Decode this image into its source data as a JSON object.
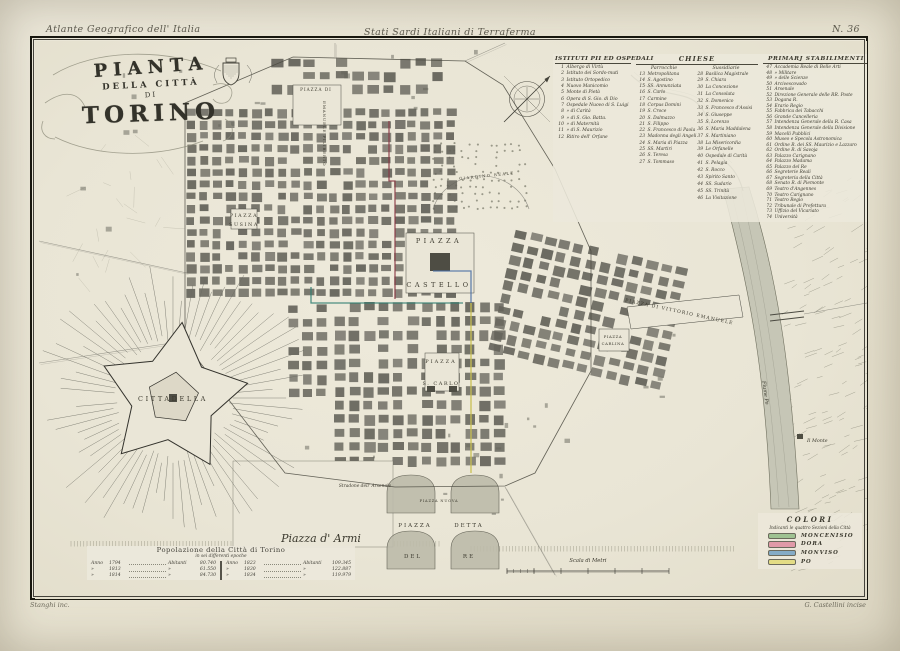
{
  "page": {
    "top_left_annotation": "Atlante Geografico dell' Italia",
    "top_center_annotation": "Stati Sardi Italiani di Terraferma",
    "plate_number": "N. 36",
    "bottom_left_signature": "Stanghi inc.",
    "bottom_right_signature": "G. Castellini incise"
  },
  "title": {
    "line1": "PIANTA",
    "line2": "DELLA CITTÀ",
    "line3": "DI",
    "line4": "TORINO"
  },
  "legend": {
    "col1_header": "ISTITUTI PII ED OSPEDALI",
    "chiese_header": "CHIESE",
    "parrocchie_subheader": "Parrocchie",
    "sussidiarie_subheader": "Sussidiarie",
    "primarj_header": "PRIMARJ STABILIMENTI",
    "istituti": [
      {
        "n": "1",
        "name": "Albergo di Virtù"
      },
      {
        "n": "2",
        "name": "Istituto dei Sordo-muti"
      },
      {
        "n": "3",
        "name": "Istituto Ortopedico"
      },
      {
        "n": "4",
        "name": "Nuovo Manicomio"
      },
      {
        "n": "5",
        "name": "Monte di Pietà"
      },
      {
        "n": "6",
        "name": "Opera di S. Gio. di Dio"
      },
      {
        "n": "7",
        "name": "Ospedale Nuovo di S. Luigi"
      },
      {
        "n": "8",
        "name": "»  di Carità"
      },
      {
        "n": "9",
        "name": "»  di S. Gio. Batta."
      },
      {
        "n": "10",
        "name": "»  di Maternità"
      },
      {
        "n": "11",
        "name": "»  di S. Maurizio"
      },
      {
        "n": "12",
        "name": "Ritiro dell' Orfane"
      }
    ],
    "parrocchie": [
      {
        "n": "13",
        "name": "Metropolitana"
      },
      {
        "n": "14",
        "name": "S. Agostino"
      },
      {
        "n": "15",
        "name": "SS. Annunziata"
      },
      {
        "n": "16",
        "name": "S. Carlo"
      },
      {
        "n": "17",
        "name": "Carmine"
      },
      {
        "n": "18",
        "name": "Corpus Domini"
      },
      {
        "n": "19",
        "name": "S. Croce"
      },
      {
        "n": "20",
        "name": "S. Dalmazzo"
      },
      {
        "n": "21",
        "name": "S. Filippo"
      },
      {
        "n": "22",
        "name": "S. Francesco di Paola"
      },
      {
        "n": "23",
        "name": "Madonna degli Angeli"
      },
      {
        "n": "24",
        "name": "S. Maria di Piazza"
      },
      {
        "n": "25",
        "name": "SS. Martiri"
      },
      {
        "n": "26",
        "name": "S. Teresa"
      },
      {
        "n": "27",
        "name": "S. Tommaso"
      }
    ],
    "sussidiarie": [
      {
        "n": "28",
        "name": "Basilica Magistrale"
      },
      {
        "n": "29",
        "name": "S. Chiara"
      },
      {
        "n": "30",
        "name": "La Concezione"
      },
      {
        "n": "31",
        "name": "La Consolata"
      },
      {
        "n": "32",
        "name": "S. Domenico"
      },
      {
        "n": "33",
        "name": "S. Francesco d'Assisi"
      },
      {
        "n": "34",
        "name": "S. Giuseppe"
      },
      {
        "n": "35",
        "name": "S. Lorenzo"
      },
      {
        "n": "36",
        "name": "S. Maria Maddalena"
      },
      {
        "n": "37",
        "name": "S. Martiniano"
      },
      {
        "n": "38",
        "name": "La Misericordia"
      },
      {
        "n": "39",
        "name": "Le Orfanelle"
      },
      {
        "n": "40",
        "name": "Ospedale di Carità"
      },
      {
        "n": "41",
        "name": "S. Pelagia"
      },
      {
        "n": "42",
        "name": "S. Rocco"
      },
      {
        "n": "43",
        "name": "Spirito Santo"
      },
      {
        "n": "44",
        "name": "SS. Sudario"
      },
      {
        "n": "45",
        "name": "SS. Trinità"
      },
      {
        "n": "46",
        "name": "La Visitazione"
      }
    ],
    "primarj": [
      {
        "n": "47",
        "name": "Accademia Reale di Belle Arti"
      },
      {
        "n": "48",
        "name": "»  Militare"
      },
      {
        "n": "49",
        "name": "»  delle Scienze"
      },
      {
        "n": "50",
        "name": "Arcivescovado"
      },
      {
        "n": "51",
        "name": "Arsenale"
      },
      {
        "n": "52",
        "name": "Direzione Generale delle RR. Poste"
      },
      {
        "n": "53",
        "name": "Dogana R."
      },
      {
        "n": "54",
        "name": "Erario Regio"
      },
      {
        "n": "55",
        "name": "Fabbrica dei Tabacchi"
      },
      {
        "n": "56",
        "name": "Grande Cancelleria"
      },
      {
        "n": "57",
        "name": "Intendenza Generale della R. Casa"
      },
      {
        "n": "58",
        "name": "Intendenza Generale della Divisione"
      },
      {
        "n": "59",
        "name": "Macelli Pubblici"
      },
      {
        "n": "60",
        "name": "Museo e Specola Astronomica"
      },
      {
        "n": "61",
        "name": "Ordine R. dei SS. Maurizio e Lazzaro"
      },
      {
        "n": "62",
        "name": "Ordine R. di Savoja"
      },
      {
        "n": "63",
        "name": "Palazzo Carignano"
      },
      {
        "n": "64",
        "name": "Palazzo Madama"
      },
      {
        "n": "65",
        "name": "Palazzo del Re"
      },
      {
        "n": "66",
        "name": "Segreterie Reali"
      },
      {
        "n": "67",
        "name": "Segreteria della Città"
      },
      {
        "n": "68",
        "name": "Senato R. di Piemonte"
      },
      {
        "n": "69",
        "name": "Teatro d'Angennes"
      },
      {
        "n": "70",
        "name": "Teatro Carignano"
      },
      {
        "n": "71",
        "name": "Teatro Regio"
      },
      {
        "n": "72",
        "name": "Tribunale di Prefettura"
      },
      {
        "n": "73",
        "name": "Uffizio del Vicariato"
      },
      {
        "n": "74",
        "name": "Università"
      }
    ]
  },
  "population_table": {
    "title": "Popolazione della Città di Torino",
    "subtitle": "in sei differenti epoche",
    "anno_label": "Anno",
    "abitanti_label": "Abitanti",
    "left_rows": [
      [
        "1794",
        "80.740"
      ],
      [
        "1813",
        "61.550"
      ],
      [
        "1814",
        "84.730"
      ]
    ],
    "right_rows": [
      [
        "1823",
        "109.345"
      ],
      [
        "1830",
        "122.887"
      ],
      [
        "1834",
        "119.979"
      ]
    ]
  },
  "colori": {
    "title": "COLORI",
    "subtitle": "Indicanti le quattro Sezioni della Città",
    "sections": [
      {
        "label": "MONCENISIO",
        "color": "#9fc292"
      },
      {
        "label": "DORA",
        "color": "#e09aa8"
      },
      {
        "label": "MONVISO",
        "color": "#84abc6"
      },
      {
        "label": "PO",
        "color": "#e3dc85"
      }
    ]
  },
  "map": {
    "section_line_colors": {
      "moncenisio": "#2f7f72",
      "dora": "#8a3642",
      "monviso": "#4a6fa5",
      "po": "#c9c050"
    },
    "labels": [
      {
        "id": "piazza-di",
        "t": "PIAZZA DI",
        "x": 281,
        "y": 50,
        "s": 4.2,
        "ls": 1,
        "a": "middle"
      },
      {
        "id": "emanuele-filiberto",
        "t": "EMANUELE FILIBERTO",
        "x": 288,
        "y": 60,
        "s": 4.1,
        "ls": 0.8,
        "rot": 90
      },
      {
        "id": "piazza-susina-1",
        "t": "PIAZZA",
        "x": 209,
        "y": 176,
        "s": 4.8,
        "ls": 1.6,
        "a": "middle"
      },
      {
        "id": "piazza-susina-2",
        "t": "SUSINA",
        "x": 209,
        "y": 185,
        "s": 4.8,
        "ls": 1.6,
        "a": "middle"
      },
      {
        "id": "piazza-castello-1",
        "t": "PIAZZA",
        "x": 404,
        "y": 202,
        "s": 6.5,
        "ls": 3.5,
        "a": "middle"
      },
      {
        "id": "piazza-castello-2",
        "t": "CASTELLO",
        "x": 404,
        "y": 246,
        "s": 6.5,
        "ls": 3.5,
        "a": "middle"
      },
      {
        "id": "piazza-s-carlo-1",
        "t": "PIAZZA",
        "x": 406,
        "y": 322,
        "s": 5,
        "ls": 2,
        "a": "middle"
      },
      {
        "id": "piazza-s-carlo-2",
        "t": "S. CARLO",
        "x": 406,
        "y": 344,
        "s": 5,
        "ls": 1.5,
        "a": "middle"
      },
      {
        "id": "piazza-vittorio-emanuele",
        "t": "PIAZZA DI VITTORIO EMANUELE",
        "x": 644,
        "y": 272,
        "s": 4.6,
        "ls": 1.1,
        "rot": 12,
        "a": "middle"
      },
      {
        "id": "piazza-carlina-1",
        "t": "PIAZZA",
        "x": 578,
        "y": 297,
        "s": 3.8,
        "ls": 0.6,
        "a": "middle"
      },
      {
        "id": "piazza-carlina-2",
        "t": "CARLINA",
        "x": 578,
        "y": 304,
        "s": 3.8,
        "ls": 0.6,
        "a": "middle"
      },
      {
        "id": "cittadella",
        "t": "CITTADELLA",
        "x": 138,
        "y": 360,
        "s": 6.5,
        "ls": 2.6,
        "a": "middle"
      },
      {
        "id": "piazza-d-armi",
        "t": "Piazza d' Armi",
        "x": 286,
        "y": 501,
        "s": 11,
        "it": 1,
        "a": "middle"
      },
      {
        "id": "piazza-detta-1",
        "t": "PIAZZA",
        "x": 380,
        "y": 486,
        "s": 5.5,
        "ls": 2,
        "a": "middle"
      },
      {
        "id": "piazza-detta-2",
        "t": "DETTA",
        "x": 434,
        "y": 486,
        "s": 5.5,
        "ls": 2,
        "a": "middle"
      },
      {
        "id": "piazza-detta-3",
        "t": "DEL",
        "x": 378,
        "y": 517,
        "s": 5.5,
        "ls": 2,
        "a": "middle"
      },
      {
        "id": "piazza-detta-4",
        "t": "RE",
        "x": 434,
        "y": 517,
        "s": 5.5,
        "ls": 2,
        "a": "middle"
      },
      {
        "id": "piazza-nuova",
        "t": "PIAZZA NUOVA",
        "x": 404,
        "y": 461,
        "s": 3.6,
        "ls": 0.8,
        "a": "middle"
      },
      {
        "id": "stradone-arsenale",
        "t": "Stradone dell' Arsenale",
        "x": 330,
        "y": 446,
        "s": 4.4,
        "it": 1,
        "a": "middle"
      },
      {
        "id": "giardino-reale",
        "t": "GIARDINO REALE",
        "x": 452,
        "y": 136,
        "s": 3.8,
        "ls": 1.4,
        "rot": -6,
        "a": "middle"
      },
      {
        "id": "scala-di-metri",
        "t": "Scala di Metri",
        "x": 553,
        "y": 521,
        "s": 5.2,
        "it": 1,
        "a": "middle"
      },
      {
        "id": "il-monte",
        "t": "Il Monte",
        "x": 772,
        "y": 401,
        "s": 4.8,
        "it": 1
      },
      {
        "id": "fiume-po",
        "t": "Fiume Po",
        "x": 729,
        "y": 352,
        "s": 5,
        "it": 1,
        "rot": 82,
        "a": "middle"
      }
    ]
  }
}
